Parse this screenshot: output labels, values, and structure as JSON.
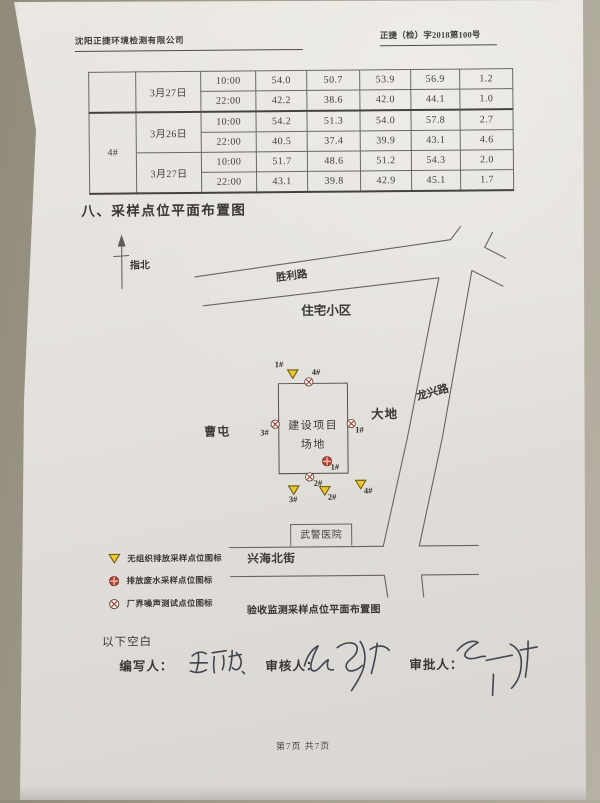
{
  "header": {
    "company": "沈阳正捷环境检测有限公司",
    "doc_no": "正捷（检）字2018第100号"
  },
  "table": {
    "point_labels": [
      "",
      "4#"
    ],
    "dates": [
      "3月27日",
      "3月26日",
      "3月27日"
    ],
    "rows": [
      {
        "time": "10:00",
        "v": [
          "54.0",
          "50.7",
          "53.9",
          "56.9",
          "1.2"
        ]
      },
      {
        "time": "22:00",
        "v": [
          "42.2",
          "38.6",
          "42.0",
          "44.1",
          "1.0"
        ]
      },
      {
        "time": "10:00",
        "v": [
          "54.2",
          "51.3",
          "54.0",
          "57.8",
          "2.7"
        ]
      },
      {
        "time": "22:00",
        "v": [
          "40.5",
          "37.4",
          "39.9",
          "43.1",
          "4.6"
        ]
      },
      {
        "time": "10:00",
        "v": [
          "51.7",
          "48.6",
          "51.2",
          "54.3",
          "2.0"
        ]
      },
      {
        "time": "22:00",
        "v": [
          "43.1",
          "39.8",
          "42.9",
          "45.1",
          "1.7"
        ]
      }
    ]
  },
  "section_title": "八、采样点位平面布置图",
  "map": {
    "compass": "指北",
    "roads": {
      "shengli": "胜利路",
      "longxing": "龙兴路",
      "xinghai": "兴海北街"
    },
    "areas": {
      "residential": "住宅小区",
      "caotun": "曹屯",
      "dadi": "大地",
      "hospital": "武警医院"
    },
    "site": {
      "line1": "建设项目",
      "line2": "场地"
    },
    "points": [
      {
        "type": "unorganized-emission",
        "label": "1#"
      },
      {
        "type": "boundary-noise",
        "label": "4#"
      },
      {
        "type": "boundary-noise",
        "label": "3#"
      },
      {
        "type": "boundary-noise",
        "label": "1#"
      },
      {
        "type": "wastewater",
        "label": "1#"
      },
      {
        "type": "boundary-noise",
        "label": "2#"
      },
      {
        "type": "unorganized-emission",
        "label": "3#"
      },
      {
        "type": "unorganized-emission",
        "label": "2#"
      },
      {
        "type": "unorganized-emission",
        "label": "4#"
      }
    ],
    "caption": "验收监测采样点位平面布置图"
  },
  "legend": {
    "items": [
      {
        "type": "unorganized-emission",
        "label": "无组织排放采样点位图标"
      },
      {
        "type": "wastewater",
        "label": "排放废水采样点位图标"
      },
      {
        "type": "boundary-noise",
        "label": "厂界噪声测试点位图标"
      }
    ]
  },
  "signoff": {
    "blank_note": "以下空白",
    "writer": "编写人：",
    "reviewer": "审核人：",
    "approver": "审批人："
  },
  "footer": {
    "page": "第7页 共7页"
  },
  "colors": {
    "triangle_fill": "#eec82a",
    "marker_red": "#bf4434",
    "paper": "#e3e0db",
    "backdrop": "#a5a090",
    "ink": "#262a38"
  }
}
